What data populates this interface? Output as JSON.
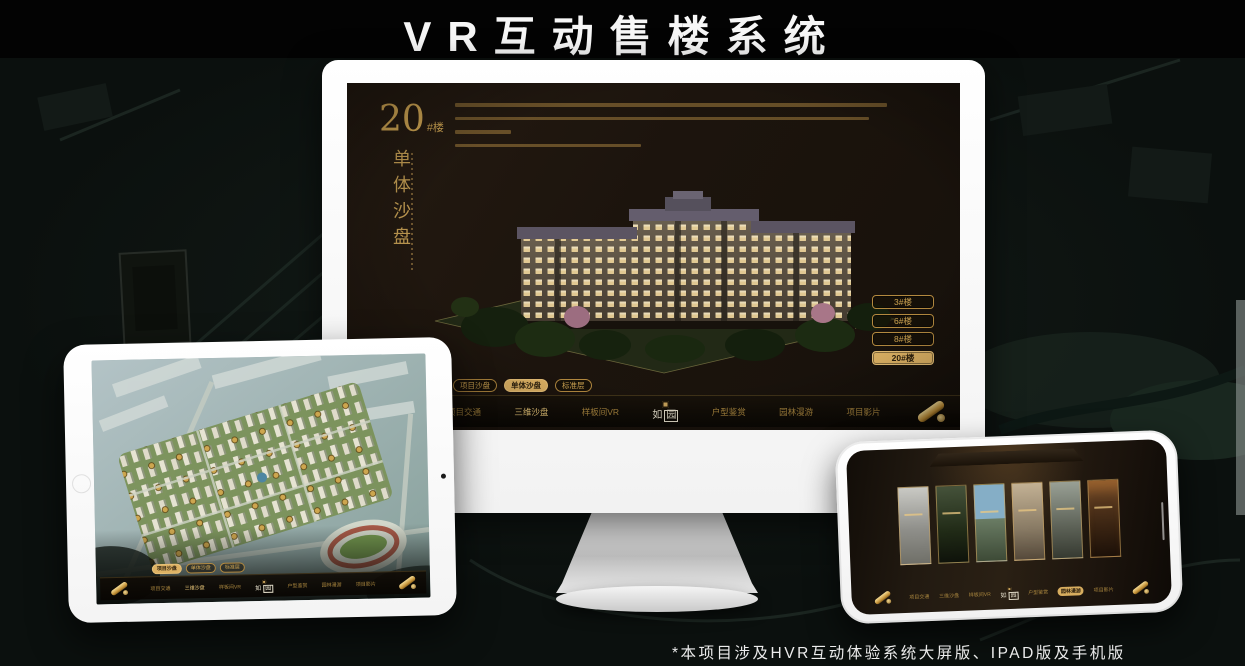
{
  "banner": {
    "title": "VR互动售楼系统"
  },
  "footnote": "*本项目涉及HVR互动体验系统大屏版、IPAD版及手机版",
  "colors": {
    "gold": "#cfa552",
    "gold_active_fill": "#ddb264",
    "screen_bg": "#1c140d"
  },
  "nav": {
    "items": [
      "项目交通",
      "三维沙盘",
      "样板间VR",
      "户型鉴赏",
      "园林漫游",
      "项目影片"
    ],
    "logo_char_1": "如",
    "logo_char_2": "园"
  },
  "sub_tabs": [
    "项目沙盘",
    "单体沙盘",
    "标准层"
  ],
  "monitor_screen": {
    "unit_number": "20",
    "unit_suffix": "#楼",
    "unit_title_vertical": "单体沙盘",
    "floor_buttons": [
      "3#楼",
      "6#楼",
      "8#楼",
      "20#楼"
    ],
    "active_floor": "20#楼",
    "active_sub_tab": "单体沙盘",
    "active_nav_item": "三维沙盘"
  },
  "tablet_screen": {
    "active_sub_tab": "项目沙盘",
    "active_nav_item": "三维沙盘"
  },
  "phone_screen": {
    "active_nav_item": "园林漫游",
    "gallery_panel_count": "6"
  }
}
